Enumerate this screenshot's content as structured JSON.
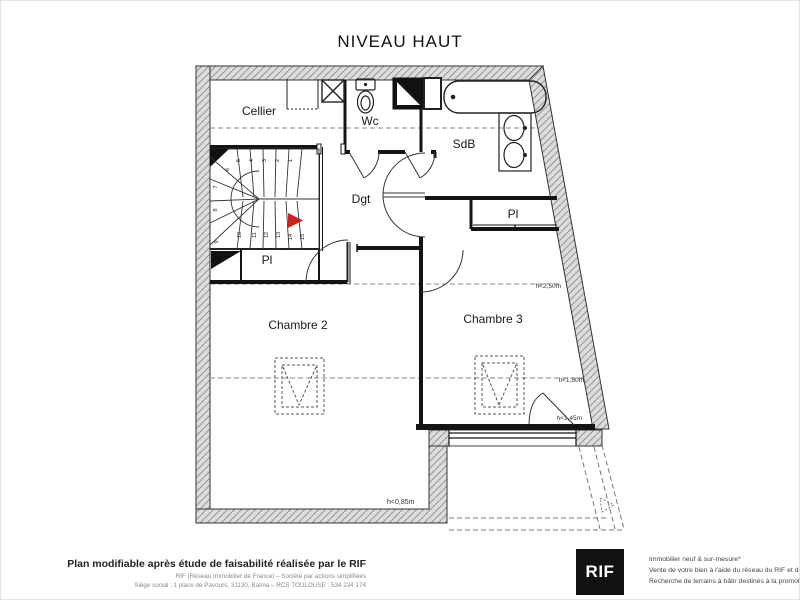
{
  "title": "NIVEAU HAUT",
  "plan": {
    "rooms": {
      "cellier": "Cellier",
      "wc": "Wc",
      "sdb": "SdB",
      "dgt": "Dgt",
      "pl_right": "Pl",
      "pl_left": "Pl",
      "chambre2": "Chambre 2",
      "chambre3": "Chambre 3"
    },
    "stairs": {
      "steps": [
        "1",
        "2",
        "3",
        "4",
        "5",
        "6",
        "7",
        "8",
        "9",
        "10",
        "11",
        "12",
        "13",
        "14",
        "15"
      ]
    },
    "measurements": {
      "m250": "h<2,50m",
      "m180": "h<1,80m",
      "m145": "h<1,45m",
      "m085": "h<0,85m"
    }
  },
  "footer": {
    "left_bold": "Plan modifiable après étude de faisabilité réalisée par le RIF",
    "left_sub1": "RIF (Réseau Immobilier de France) – Société par actions simplifiées",
    "left_sub2": "Siège social : 1 place de Pavours, 31130, Balma – RCS TOULOUSE : 534 234 174",
    "logo": "RIF",
    "right_line1": "Immobilier neuf & sur-mesure*",
    "right_line2": "Vente de votre bien à l'aide du réseau du RIF et de la visite à 360°",
    "right_line3": "Recherche de terrains à bâtir destinés à la promotion immobilière"
  },
  "colors": {
    "wall_fill": "#dcdcdc",
    "line": "#1a1a1a",
    "dashed": "#8a8a8a",
    "arrow_red": "#cf2020",
    "logo_bg": "#111111"
  }
}
